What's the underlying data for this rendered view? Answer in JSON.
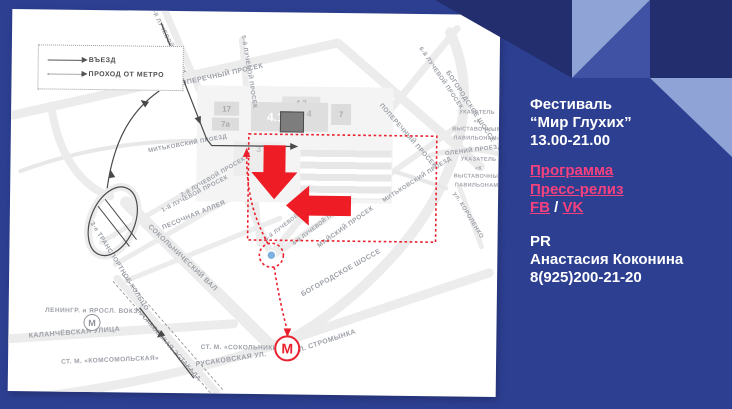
{
  "slide": {
    "background": "#2d3f91",
    "accent_dark": "#232e6e",
    "accent_medium": "#3f52a3",
    "accent_light": "#8fa3d6",
    "link_color": "#f5417d",
    "route_red": "#e9212e"
  },
  "panel": {
    "title_line1": "Фестиваль",
    "title_line2": "“Мир Глухих”",
    "title_line3": "13.00-21.00",
    "link_program": "Программа",
    "link_press": "Пресс-релиз",
    "link_fb": "FB",
    "link_separator": "/",
    "link_vk": "VK",
    "pr_label": "PR",
    "pr_name": "Анастасия Коконина",
    "pr_phone": "8(925)200-21-20"
  },
  "map": {
    "legend": {
      "entry_label": "ВЪЕЗД",
      "metro_label": "ПРОХОД ОТ МЕТРО"
    },
    "signs": [
      "УКАЗАТЕЛЬ\n«К ВЫСТАВОЧНЫМ\nПАВИЛЬОНАМ»",
      "УКАЗАТЕЛЬ\n«К ВЫСТАВОЧНЫМ\nПАВИЛЬОНАМ»",
      "УКАЗАТЕЛЬ\n«К ВЫСТАВОЧНЫМ\nПАВИЛЬОНАМ»"
    ],
    "street_labels": [
      "ПОПЕРЕЧНЫЙ  ПРОСЕК",
      "ПОПЕРЕЧНЫЙ ПРОСЕК",
      "3-й ЛУЧЕВОЙ ПРОСЕК",
      "5-й ЛУЧЕВОЙ ПРОСЕК",
      "6-й ЛУЧЕВОЙ ПРОСЕК",
      "БОГОРОДСКОЕ ШОССЕ",
      "МИТЬКОВСКИЙ ПРОЕЗД",
      "МИТЬКОВСКИЙ ПРОЕЗД",
      "ОЛЕНИЙ ПРОЕЗД",
      "ул. КОРОЛЕНКО",
      "2-й ЛУЧЕВОЙ ПРОСЕК",
      "1-й ЛУЧЕВОЙ ПРОСЕК",
      "ПЕСОЧНАЯ АЛЛЕЯ",
      "СОКОЛЬНИЧЕСКИЙ ВАЛ",
      "3-е ТРАНСПОРТНОЕ КОЛЬЦО",
      "5-й ЛУЧЕВОЙ ПРОСЕК",
      "6-й ЛУЧЕВОЙ ПРОСЕК",
      "МАЙСКИЙ ПРОСЕК",
      "БОГОРОДСКОЕ ШОССЕ",
      "УЛ. СТРОМЫНКА",
      "РУСАКОВСКАЯ УЛ.",
      "РУСАКОВСКАЯ ЭСТАКАДА",
      "КАЛАНЧЁВСКАЯ УЛИЦА",
      "СТ. М. «КОМСОМОЛЬСКАЯ»",
      "ЛЕНИНГР. и ЯРОСЛ. ВОКЗ.",
      "СТ. М. «СОКОЛЬНИКИ»"
    ],
    "buildings": [
      "17",
      "7а",
      "4.1",
      "4",
      "4.2",
      "7",
      "3",
      "1"
    ],
    "metro_red_label": "М",
    "metro_gray_label": "М"
  }
}
